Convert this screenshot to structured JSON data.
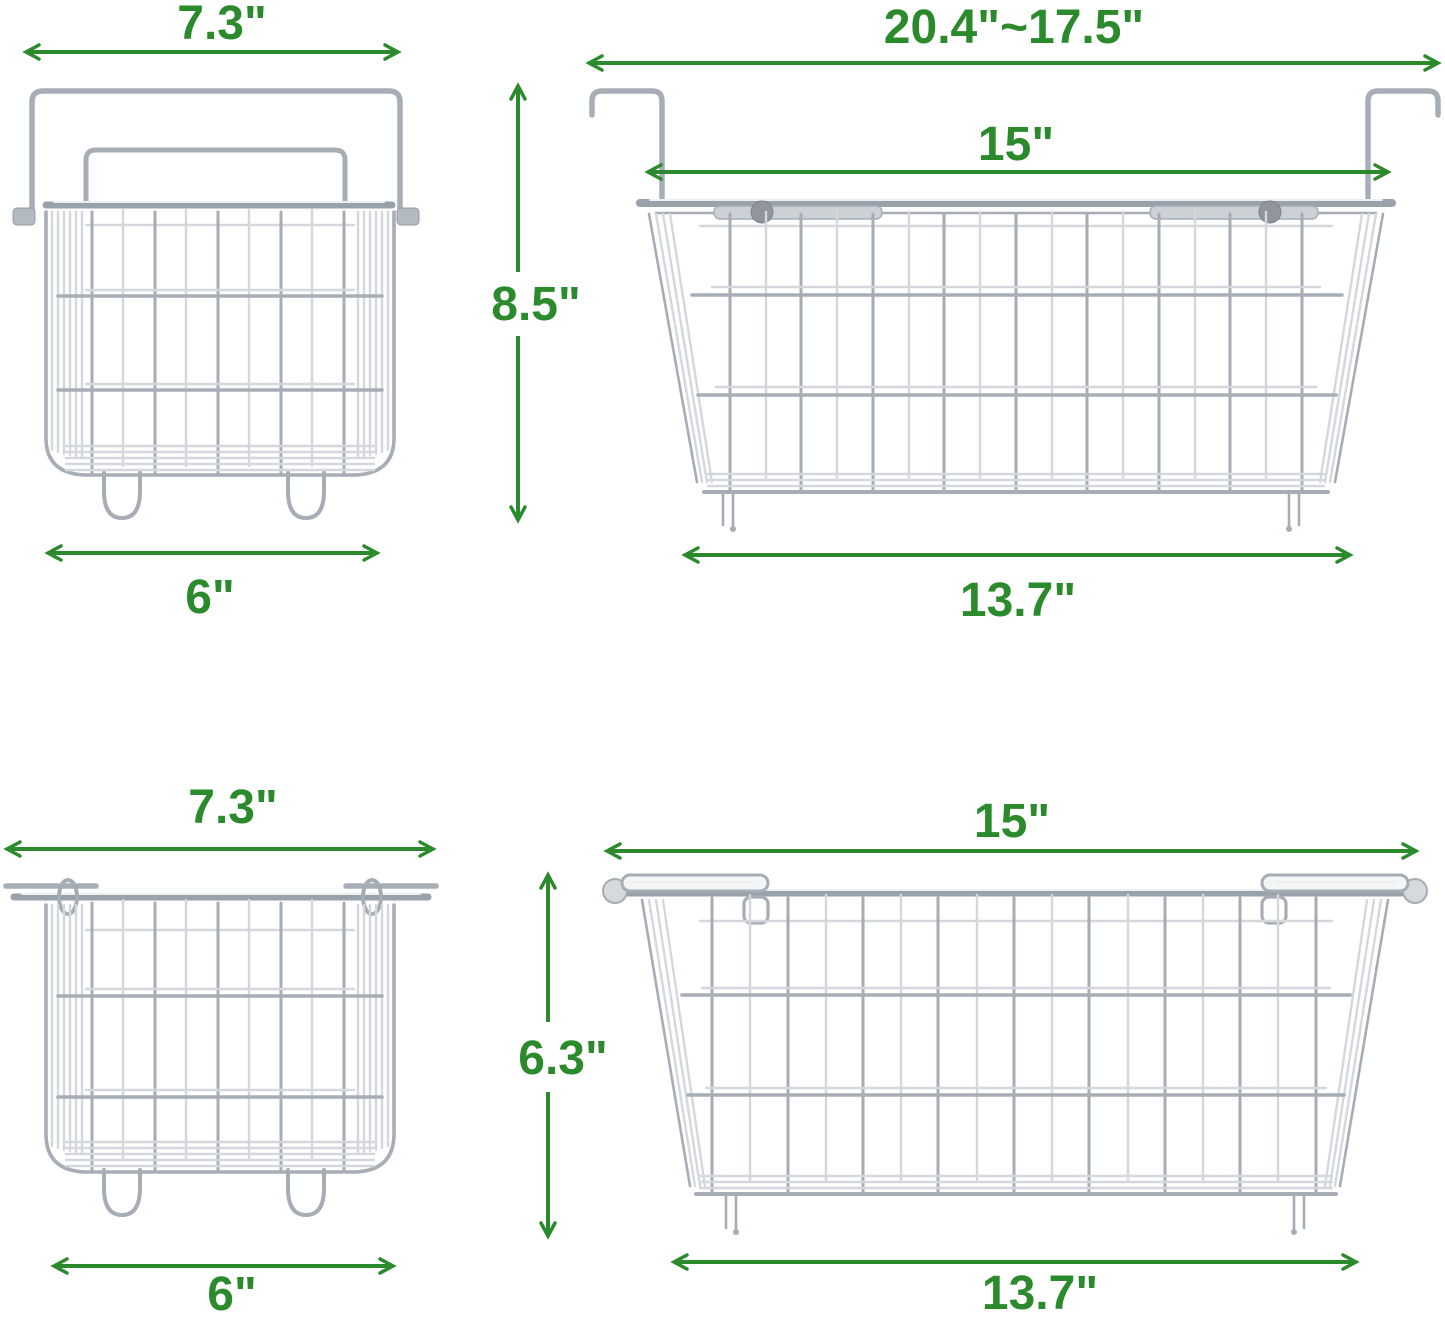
{
  "colors": {
    "dimension_green": "#2b8a2b",
    "wire_front": "#a6adb5",
    "wire_back": "#d4d8dc",
    "wire_rim": "#99a1aa"
  },
  "dimensions": {
    "small_basket_top": {
      "top_width": "7.3\"",
      "height": "8.5\"",
      "bottom_width": "6\""
    },
    "large_basket_top": {
      "overall_width": "20.4\"~17.5\"",
      "inner_width": "15\"",
      "bottom_width": "13.7\""
    },
    "small_basket_bottom": {
      "top_width": "7.3\"",
      "height": "6.3\"",
      "bottom_width": "6\""
    },
    "large_basket_bottom": {
      "top_width": "15\"",
      "bottom_width": "13.7\""
    }
  }
}
